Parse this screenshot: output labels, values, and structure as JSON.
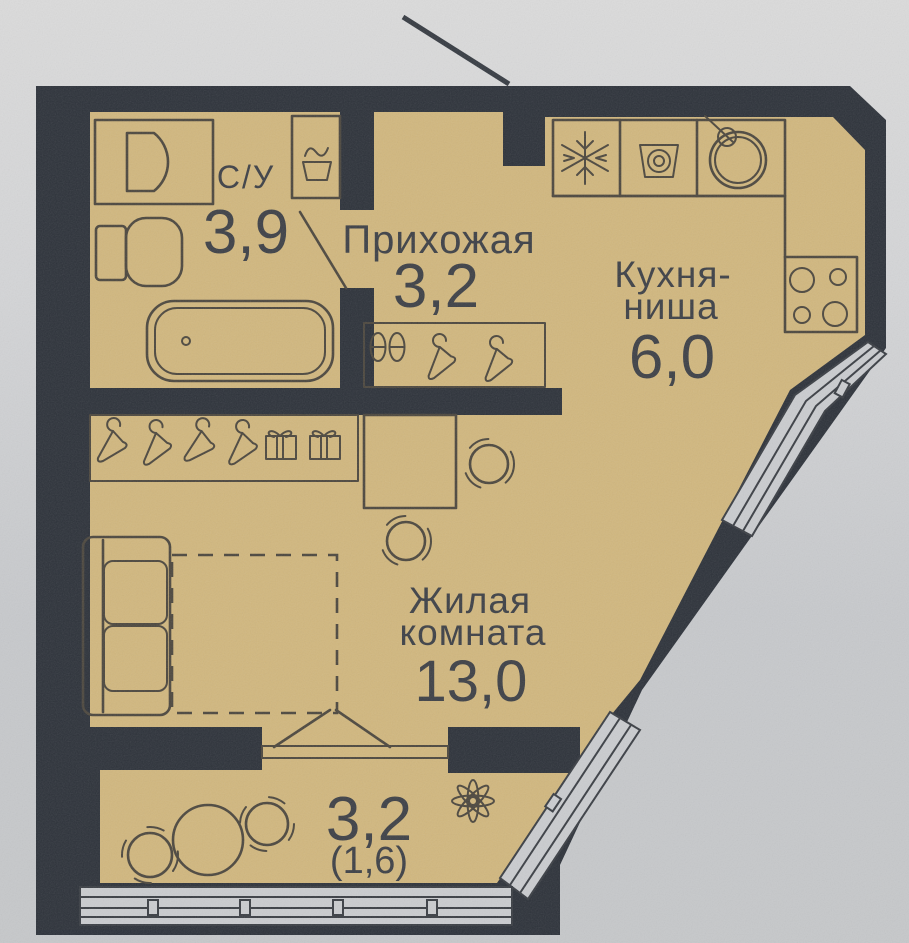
{
  "plan": {
    "type_note": "apartment floor plan photo",
    "rooms": {
      "bathroom": {
        "name": "С/У",
        "area": "3,9"
      },
      "hallway": {
        "name": "Прихожая",
        "area": "3,2"
      },
      "kitchen": {
        "name_line1": "Кухня-",
        "name_line2": "ниша",
        "area": "6,0"
      },
      "living": {
        "name_line1": "Жилая",
        "name_line2": "комната",
        "area": "13,0"
      },
      "balcony": {
        "area": "3,2",
        "area_secondary": "(1,6)"
      }
    },
    "icons": [
      "vanity-sink-icon",
      "laundry-basket-icon",
      "toilet-icon",
      "bathtub-icon",
      "fridge-snowflake-icon",
      "washing-machine-icon",
      "kitchen-sink-icon",
      "stove-burners-icon",
      "hanger-icon",
      "storage-box-icon",
      "shoe-pair-icon",
      "sofa-icon",
      "desk-icon",
      "chair-icon",
      "round-table-icon",
      "plant-icon",
      "window-band-icon",
      "door-swing-icon",
      "leader-line"
    ],
    "colors": {
      "floor": "#d1b77e",
      "walls": "#2d323a",
      "glazing": "#cacccf",
      "background_top": "#dbdbdb",
      "background_bottom": "#c6c8ca",
      "line": "#4c473e",
      "text": "#3d4046"
    }
  }
}
